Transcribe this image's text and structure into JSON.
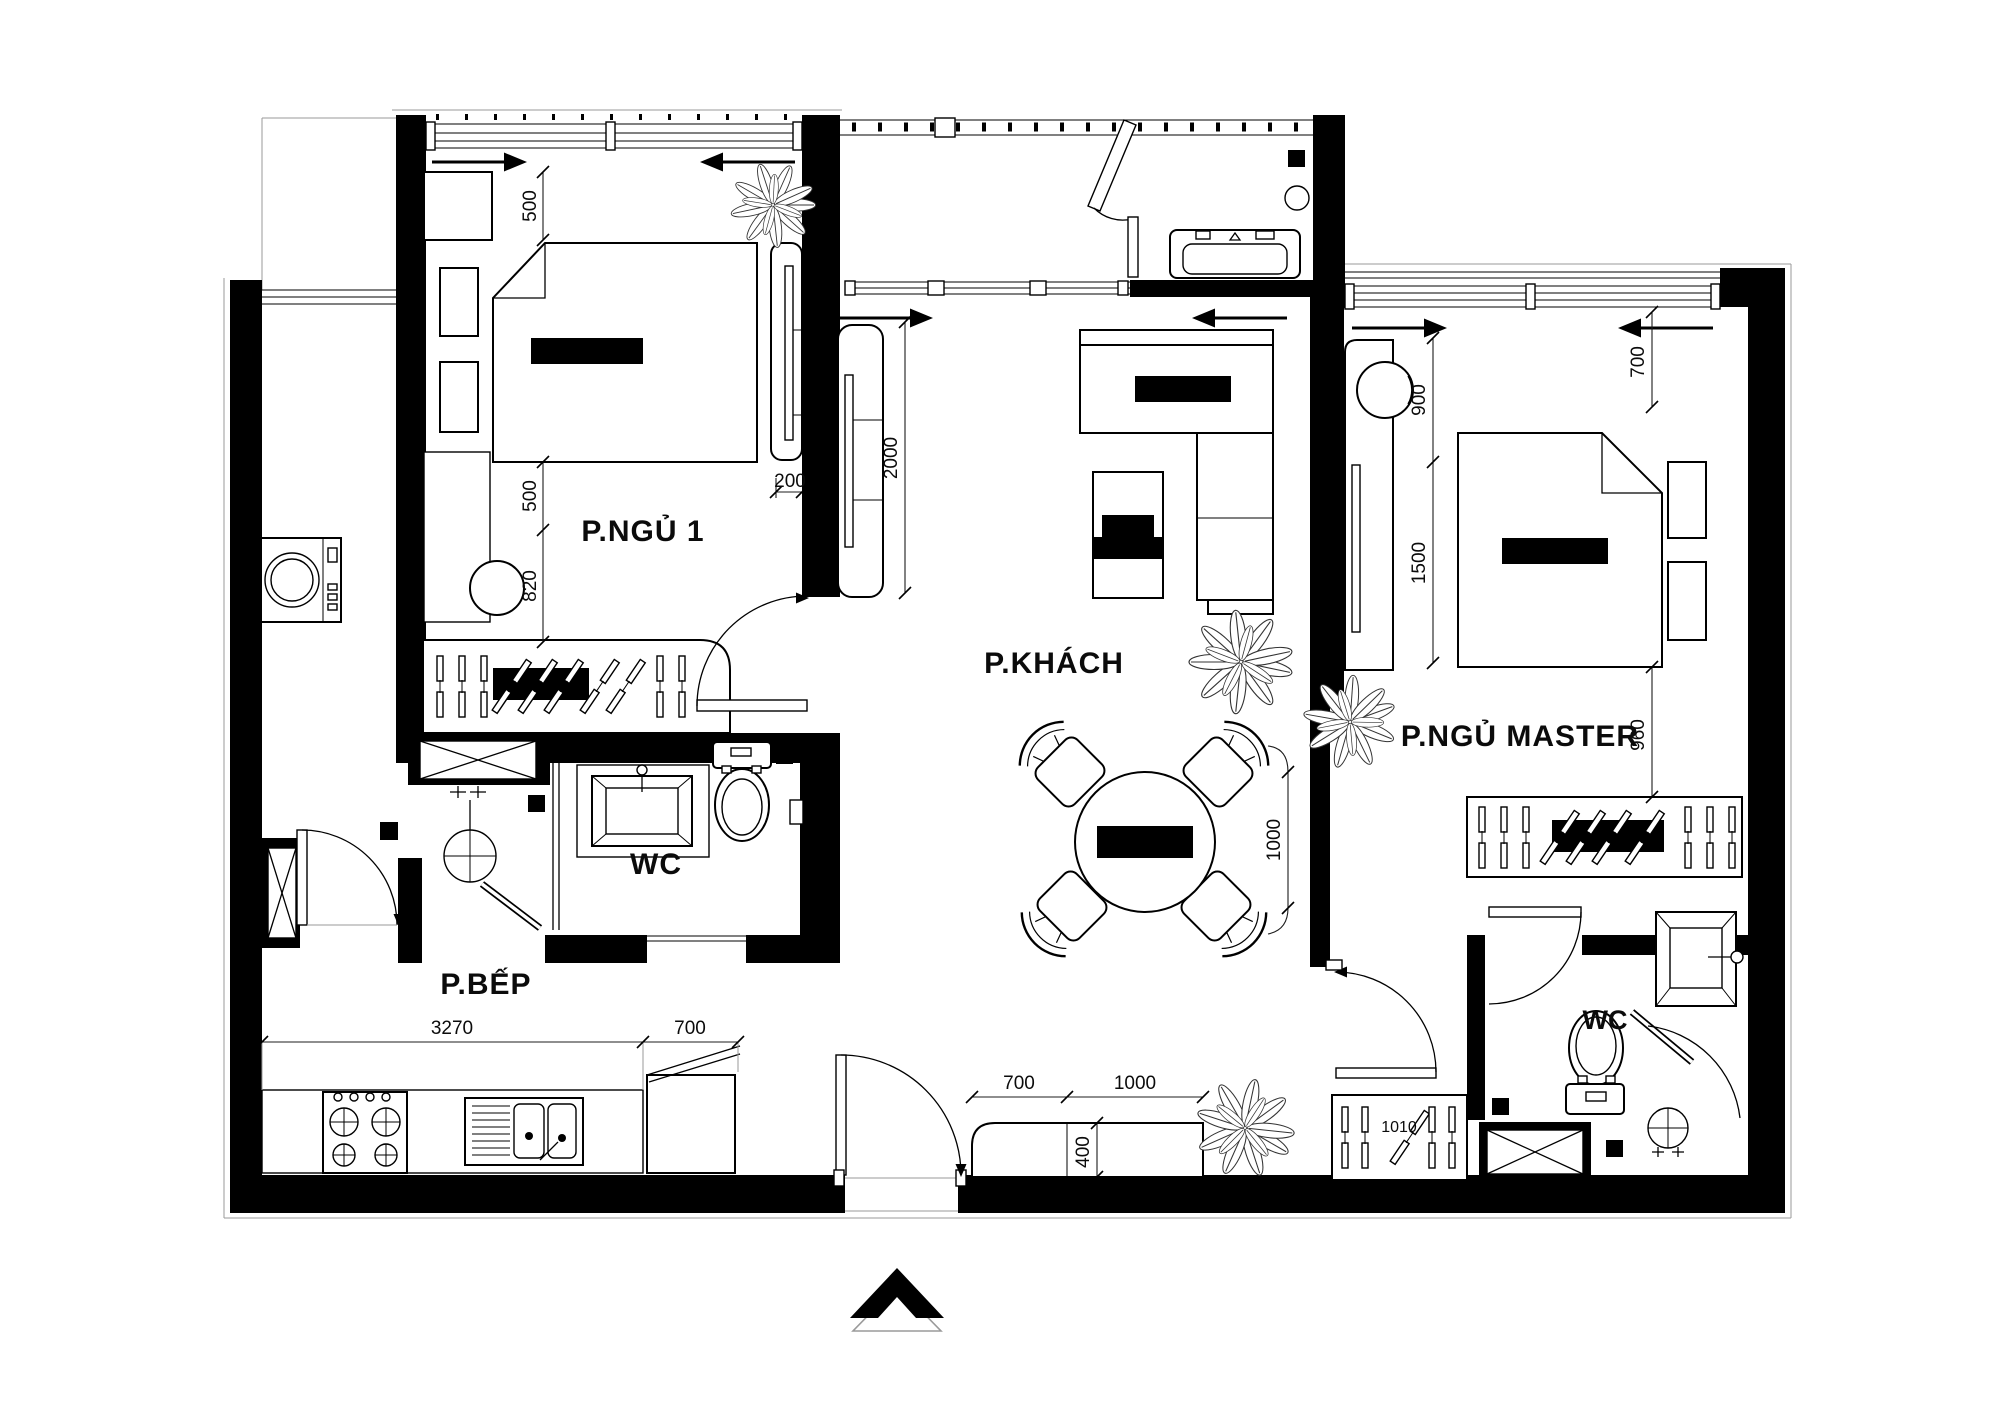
{
  "drawing": {
    "kind": "apartment-floor-plan",
    "language": "vi"
  },
  "colors": {
    "wall": "#000000",
    "line": "#1c1c1c",
    "paper": "#ffffff",
    "dim_text": "#0b0b0b",
    "north_gray": "#9a9a9a"
  },
  "rooms": [
    {
      "id": "bedroom-1",
      "label": "P.NGỦ 1"
    },
    {
      "id": "living-room",
      "label": "P.KHÁCH"
    },
    {
      "id": "master-bedroom",
      "label": "P.NGỦ MASTER"
    },
    {
      "id": "wc-1",
      "label": "WC"
    },
    {
      "id": "wc-master",
      "label": "WC"
    },
    {
      "id": "kitchen",
      "label": "P.BẾP"
    }
  ],
  "dims": {
    "bed1_top_500": "500",
    "bed1_mid_500": "500",
    "bed1_820": "820",
    "tv_wall_200": "200",
    "living_tv_2000": "2000",
    "living_wall_1000": "1000",
    "master_900": "900",
    "master_1500": "1500",
    "master_top_700": "700",
    "master_960": "960",
    "kitchen_3270": "3270",
    "fridge_700": "700",
    "shoe_700": "700",
    "shoe_1000": "1000",
    "shoe_400": "400",
    "master_wardrobe_1010": "1010"
  },
  "symbols": [
    "north-arrow",
    "door-swing",
    "sliding-window-arrow",
    "plant",
    "floor-drain",
    "wardrobe-hangers",
    "washing-machine",
    "shower-head",
    "shaft-cross"
  ]
}
